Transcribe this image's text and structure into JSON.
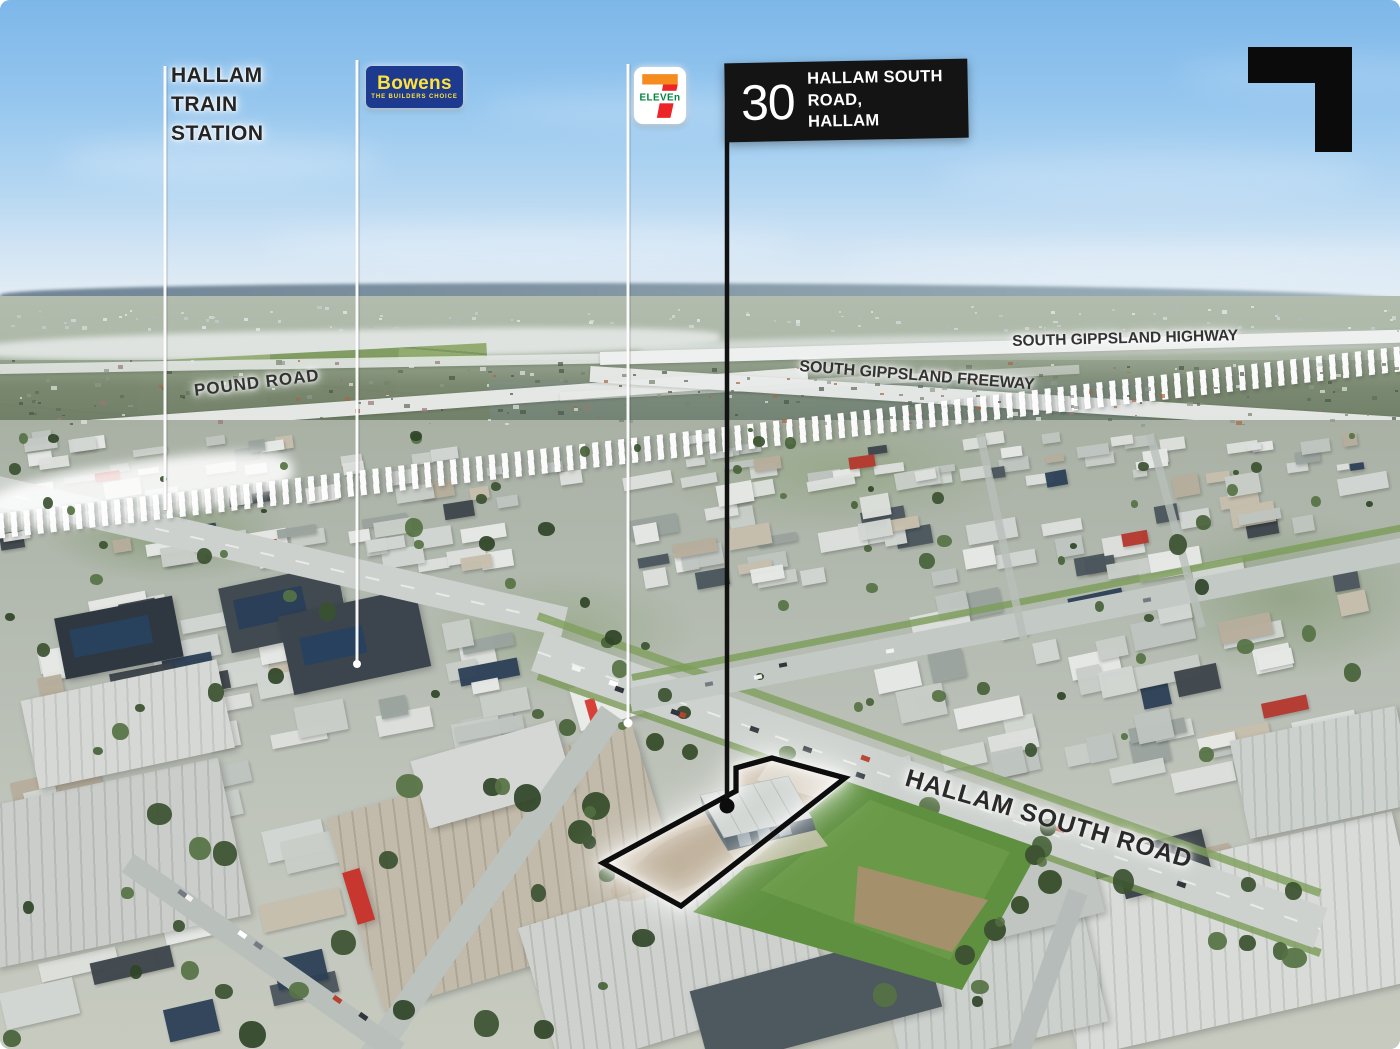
{
  "markers": {
    "train_station": {
      "lines": [
        "HALLAM",
        "TRAIN",
        "STATION"
      ]
    },
    "bowens": {
      "brand": "Bowens",
      "tagline": "THE BUILDERS CHOICE"
    },
    "seven_eleven": {
      "name": "7-Eleven",
      "numeral": "7",
      "wordmark": "ELEVEn"
    },
    "property": {
      "number": "30",
      "street": "HALLAM SOUTH ROAD,",
      "suburb": "HALLAM"
    }
  },
  "road_labels": {
    "pound": "POUND ROAD",
    "highway": "SOUTH GIPPSLAND HIGHWAY",
    "freeway": "SOUTH GIPPSLAND FREEWAY",
    "hallam_south": "HALLAM SOUTH ROAD"
  },
  "colors": {
    "bowens_navy": "#1d3a8f",
    "bowens_yellow": "#ffe23c",
    "seven_orange": "#f68b1f",
    "seven_red": "#ee2526",
    "seven_green": "#00843d",
    "callout_bg": "#141414",
    "callout_text": "#ffffff",
    "site_outline": "#0a0a0a",
    "site_outline_glow": "#ffffff",
    "marker_line": "#ffffff"
  }
}
